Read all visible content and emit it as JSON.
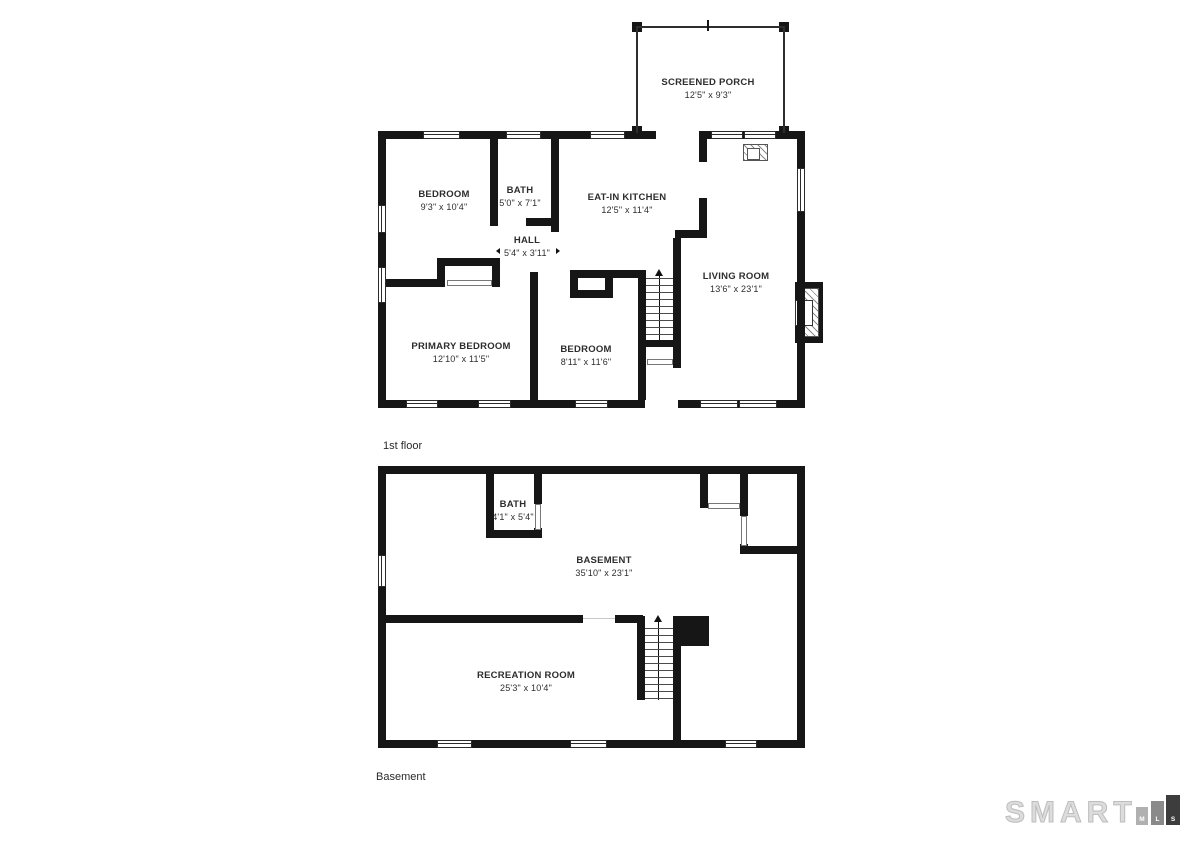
{
  "page": {
    "background": "#ffffff",
    "wall_color": "#161616",
    "text_color": "#2d2d2d"
  },
  "floor1": {
    "caption": "1st floor",
    "rooms": {
      "screened_porch": {
        "name": "SCREENED PORCH",
        "dims": "12'5\" x 9'3\""
      },
      "bedroom": {
        "name": "BEDROOM",
        "dims": "9'3\" x 10'4\""
      },
      "bath": {
        "name": "BATH",
        "dims": "5'0\" x 7'1\""
      },
      "eat_in_kitchen": {
        "name": "EAT-IN KITCHEN",
        "dims": "12'5\" x 11'4\""
      },
      "hall": {
        "name": "HALL",
        "dims": "5'4\" x 3'11\""
      },
      "living_room": {
        "name": "LIVING ROOM",
        "dims": "13'6\" x 23'1\""
      },
      "primary_bedroom": {
        "name": "PRIMARY BEDROOM",
        "dims": "12'10\" x 11'5\""
      },
      "bedroom2": {
        "name": "BEDROOM",
        "dims": "8'11\" x 11'6\""
      }
    }
  },
  "basement": {
    "caption": "Basement",
    "rooms": {
      "bath": {
        "name": "BATH",
        "dims": "4'1\" x 5'4\""
      },
      "basement": {
        "name": "BASEMENT",
        "dims": "35'10\" x 23'1\""
      },
      "recreation_room": {
        "name": "RECREATION ROOM",
        "dims": "25'3\" x 10'4\""
      }
    }
  },
  "logo": {
    "wordmark": "SMART",
    "blocks": [
      {
        "letter": "M",
        "color": "#b0b0b0"
      },
      {
        "letter": "L",
        "color": "#8a8a8a"
      },
      {
        "letter": "S",
        "color": "#3d3d3d"
      }
    ]
  }
}
